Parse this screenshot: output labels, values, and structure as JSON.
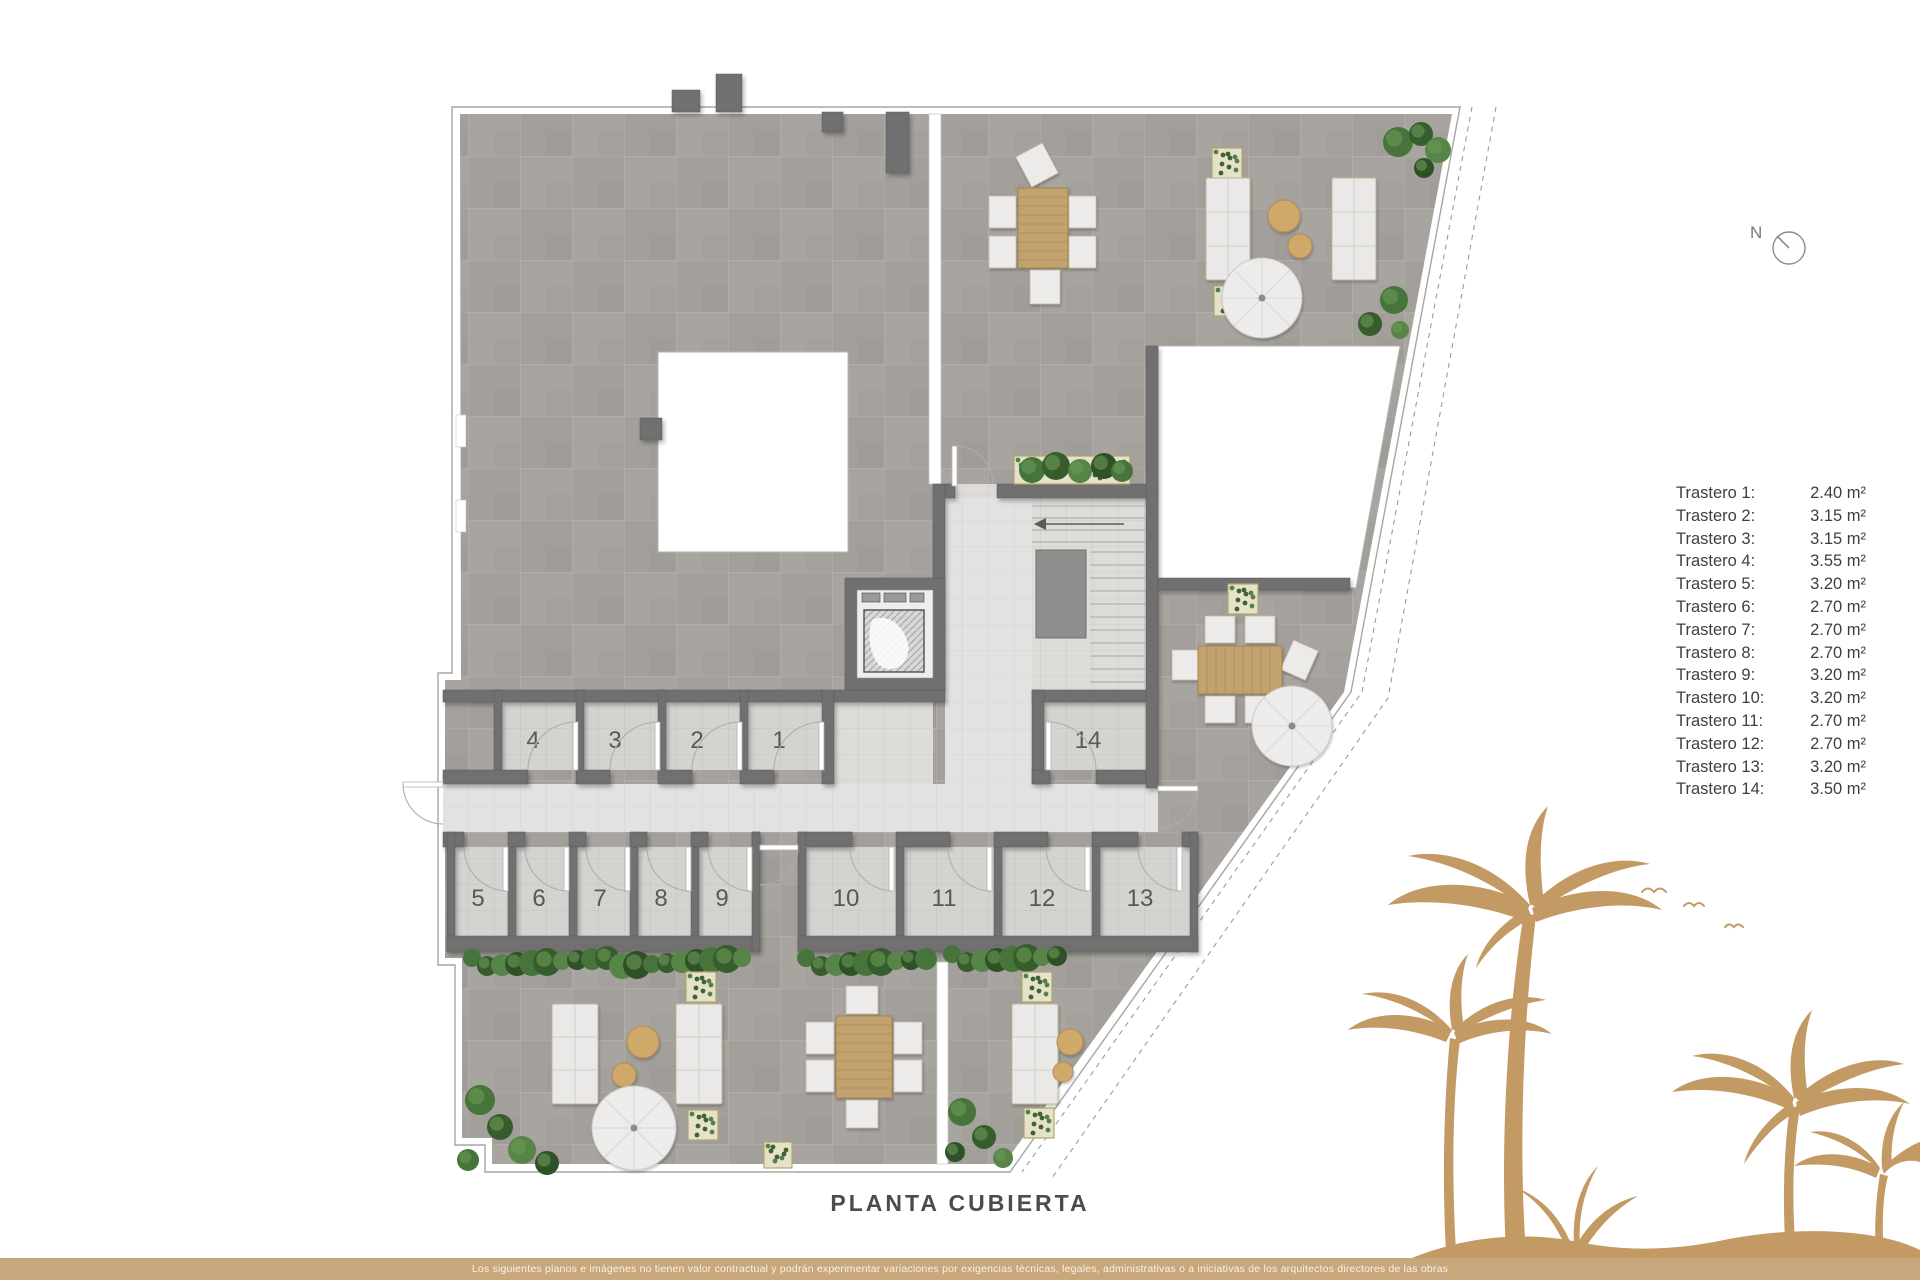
{
  "caption": {
    "title": "PLANTA CUBIERTA"
  },
  "compass": {
    "label": "N"
  },
  "plan": {
    "rooms": [
      "1",
      "2",
      "3",
      "4",
      "5",
      "6",
      "7",
      "8",
      "9",
      "10",
      "11",
      "12",
      "13",
      "14"
    ]
  },
  "legend": {
    "items": [
      {
        "label": "Trastero 1:",
        "value": "2.40 m²"
      },
      {
        "label": "Trastero 2:",
        "value": "3.15 m²"
      },
      {
        "label": "Trastero 3:",
        "value": "3.15 m²"
      },
      {
        "label": "Trastero 4:",
        "value": "3.55 m²"
      },
      {
        "label": "Trastero 5:",
        "value": "3.20 m²"
      },
      {
        "label": "Trastero 6:",
        "value": "2.70 m²"
      },
      {
        "label": "Trastero 7:",
        "value": "2.70 m²"
      },
      {
        "label": "Trastero 8:",
        "value": "2.70 m²"
      },
      {
        "label": "Trastero 9:",
        "value": "3.20 m²"
      },
      {
        "label": "Trastero 10:",
        "value": "3.20 m²"
      },
      {
        "label": "Trastero 11:",
        "value": "2.70 m²"
      },
      {
        "label": "Trastero 12:",
        "value": "2.70 m²"
      },
      {
        "label": "Trastero 13:",
        "value": "3.20 m²"
      },
      {
        "label": "Trastero 14:",
        "value": "3.50 m²"
      }
    ]
  },
  "footer": {
    "disclaimer": "Los siguientes planos e imágenes no tienen valor contractual y podrán experimentar variaciones por exigencias técnicas, legales, administrativas o a iniciativas de los arquitectos directores de las obras"
  },
  "colors": {
    "accent_tan": "#c8a77c",
    "palm_tan": "#c39a63",
    "wall_gray": "#6f6f6f",
    "terrace_gray": "#a8a4a0"
  }
}
